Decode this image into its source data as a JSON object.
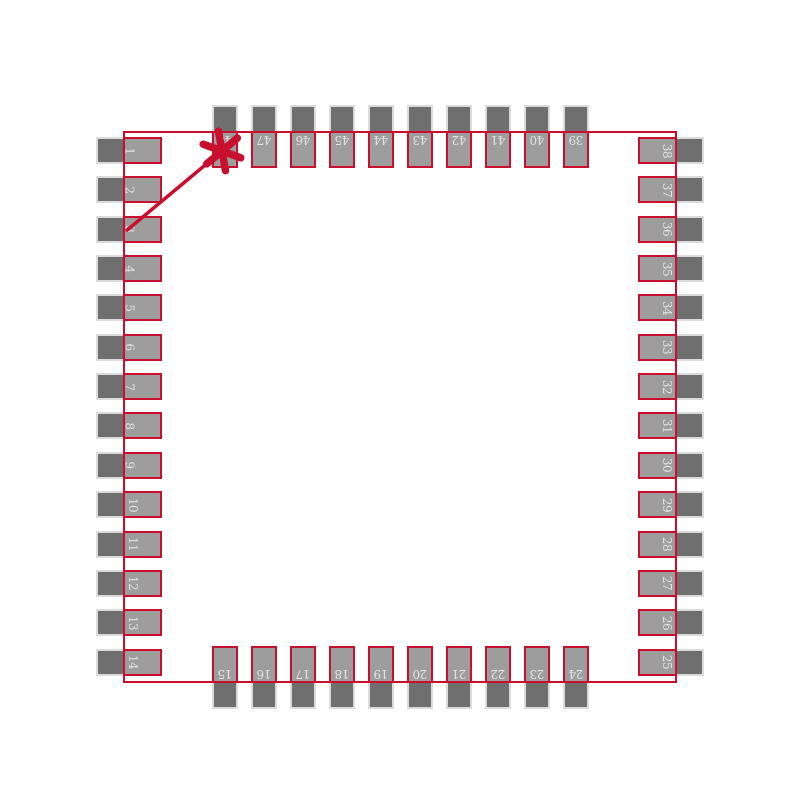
{
  "footprint": {
    "colors": {
      "background": "#FFFFFF",
      "outline_red": "#C8102E",
      "lead_stub_gray": "#6F6F6F",
      "pad_gray": "#9D9D9D",
      "stub_halo_gray": "#DBDBDB",
      "pin_number_text": "#E3E3E3"
    },
    "pin_count": 48,
    "pin1_marker": {
      "icon": "asterisk-icon",
      "color": "#C8102E"
    },
    "sides": {
      "left": {
        "pins": [
          "1",
          "2",
          "3",
          "4",
          "5",
          "6",
          "7",
          "8",
          "9",
          "10",
          "11",
          "12",
          "13",
          "14"
        ]
      },
      "top": {
        "pins": [
          "48",
          "47",
          "46",
          "45",
          "44",
          "43",
          "42",
          "41",
          "40",
          "39"
        ]
      },
      "right": {
        "pins": [
          "38",
          "37",
          "36",
          "35",
          "34",
          "33",
          "32",
          "31",
          "30",
          "29",
          "28",
          "27",
          "26",
          "25"
        ]
      },
      "bottom": {
        "pins": [
          "15",
          "16",
          "17",
          "18",
          "19",
          "20",
          "21",
          "22",
          "23",
          "24"
        ]
      }
    }
  }
}
